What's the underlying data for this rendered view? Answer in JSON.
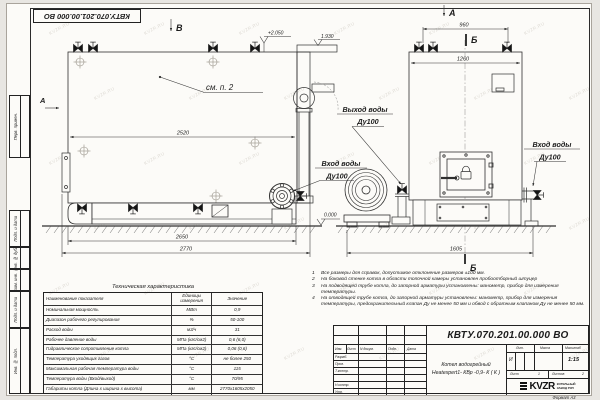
{
  "watermark": "KVZR.RU",
  "frame": {
    "side_labels": [
      "Перв. примен.",
      "Подп. и дата",
      "Инв. № дубл.",
      "Взам. инв. №",
      "Подп. и дата",
      "Инв. № подл."
    ],
    "format_label": "Формат  А3"
  },
  "drawing": {
    "view_a": "А",
    "view_b": "В",
    "section_b": "Б",
    "see_note": "см. п. 2",
    "elev_top": "+2.050",
    "elev_fan": "1.930",
    "elev_zero": "0.000",
    "dims": {
      "d2520": "2520",
      "d2650": "2650",
      "d2770": "2770",
      "d960": "960",
      "d1260": "1260",
      "d1605": "1605"
    },
    "labels": {
      "outlet_line1": "Выход воды",
      "outlet_line2": "Ду100",
      "inlet_line1": "Вход воды",
      "inlet_line2": "Ду100"
    }
  },
  "tech_table": {
    "title": "Техническая характеристика",
    "headers": [
      "Наименование показателя",
      "Единицы измерения",
      "Значение"
    ],
    "rows": [
      [
        "Номинальная мощность",
        "МВт",
        "0,9"
      ],
      [
        "Диапазон рабочего регулирования",
        "%",
        "50-100"
      ],
      [
        "Расход воды",
        "м3/ч",
        "31"
      ],
      [
        "Рабочее давление воды",
        "МПа (кгс/см2)",
        "0,6 (6,0)"
      ],
      [
        "Гидравлическое сопротивление котла",
        "МПа (кгс/см2)",
        "0,06 (0,6)"
      ],
      [
        "Температура уходящих газов",
        "°С",
        "не более 250"
      ],
      [
        "Максимальная рабочая температура воды",
        "°С",
        "115"
      ],
      [
        "Температура воды (Вход/выход)",
        "°С",
        "70/95"
      ],
      [
        "Габариты котла (Длина х ширина х высота)",
        "мм",
        "2770х1605х2050"
      ]
    ]
  },
  "notes": [
    {
      "n": "1",
      "text": "Все размеры для справок, допустимое отклонение размеров ±100 мм."
    },
    {
      "n": "2",
      "text": "На боковой стенке котла в области топочной камеры установлен пробоотборный штуцер"
    },
    {
      "n": "3",
      "text": "На  подводящей трубе котла, до запорной арматуры установлены:  манометр, прибор для измерения температуры."
    },
    {
      "n": "4",
      "text": "На отводящей трубе котла, до запорной арматуры установлены: манометр, прибор для измерения температуры, предохранительный клапан Ду не менее 50 мм и обвод с обратным клапаном Ду не менее 50 мм."
    }
  ],
  "title_block": {
    "designation": "КВТУ.070.201.00.000  ВО",
    "name_line1": "Котел водогрейный",
    "name_line2": "Heatexpert1- КВр -0,9- К ( К )",
    "cols": [
      "Изм.",
      "Лист",
      "N докум.",
      "Подп.",
      "Дата"
    ],
    "row_labels": [
      "Разраб.",
      "Пров.",
      "Т.контр.",
      "Н.контр.",
      "Утв."
    ],
    "lit_label": "Лит.",
    "mass_label": "Масса",
    "scale_label": "Масштаб",
    "lit_value": "И",
    "scale_value": "1:15",
    "sheet_label": "Лист",
    "sheet_num": "1",
    "sheets_label": "Листов",
    "sheets_num": "2",
    "logo_text": "KVZR",
    "logo_sub1": "КОТЕЛЬНЫЙ",
    "logo_sub2": "ЗАВОД РЭП"
  }
}
